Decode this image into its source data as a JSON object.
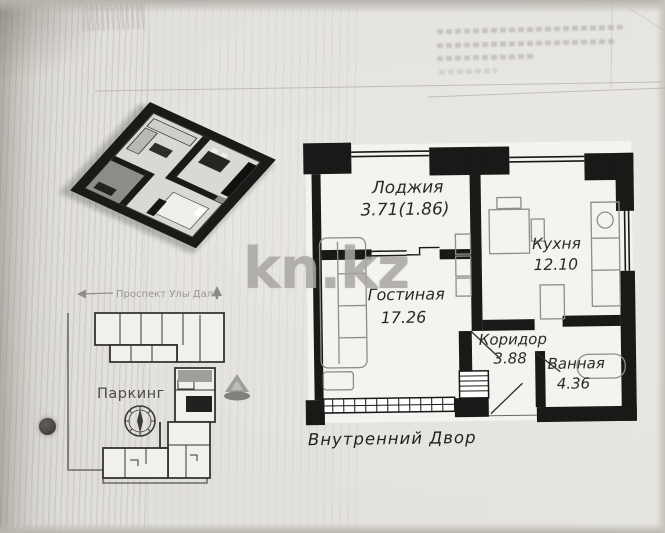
{
  "watermark": {
    "text": "kn.kz"
  },
  "floor_plan": {
    "rooms": {
      "loggia": {
        "name": "Лоджия",
        "area": "3.71(1.86)"
      },
      "kitchen": {
        "name": "Кухня",
        "area": "12.10"
      },
      "living": {
        "name": "Гостиная",
        "area": "17.26"
      },
      "corridor": {
        "name": "Коридор",
        "area": "3.88"
      },
      "bathroom": {
        "name": "Ванная",
        "area": "4.36"
      }
    },
    "courtyard_label": "Внутренний Двор"
  },
  "site_plan": {
    "parking_label": "Паркинг",
    "street_label": "Проспект Улы Дала"
  }
}
